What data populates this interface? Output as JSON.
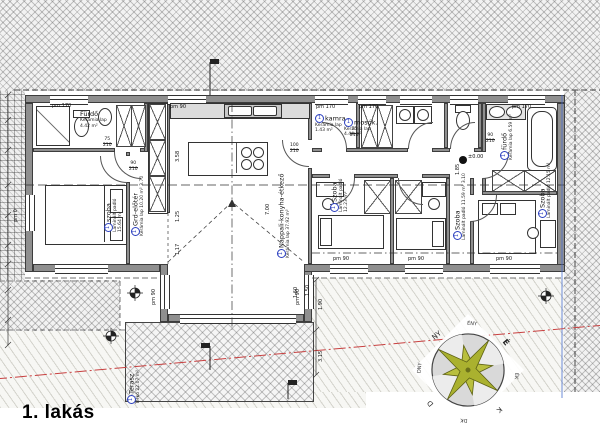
{
  "title": "1. lakás",
  "badge": "1",
  "rooms": [
    {
      "name": "Fürdő",
      "floor": "Kerámia lap",
      "area": "4.42 m²"
    },
    {
      "name": "szoba",
      "floor": "Laminált padló",
      "area": "15.64 m²"
    },
    {
      "name": "Grd-előtér",
      "floor": "Kerámia lap",
      "area": "10.20 m²",
      "dim": "3.70"
    },
    {
      "name": "Nappali-konyha-étkező",
      "floor": "Kerámia lap",
      "area": "37.92 m²"
    },
    {
      "name": "kamra",
      "floor": "Kerámia lap",
      "area": "1.43 m²"
    },
    {
      "name": "mosók.",
      "floor": "Kerámia lap",
      "area": "4.44 m²"
    },
    {
      "name": "fürdő",
      "floor": "Kerámia lap",
      "area": "6.59 m²"
    },
    {
      "name": "Szoba",
      "floor": "Laminált padló",
      "area": "12.23 m²"
    },
    {
      "name": "Szoba",
      "floor": "Laminált padló",
      "area": "11.59 m²",
      "dim": "3.10"
    },
    {
      "name": "Szoba",
      "floor": "Laminált padló",
      "area": "12.15 m²"
    },
    {
      "name": "Terasz",
      "floor": "Térkő",
      "area": "22.07 m²"
    }
  ],
  "window_labels": {
    "pm170": "pm 170",
    "pm90": "pm 90",
    "pm0": "pm 0"
  },
  "door_sizes": {
    "w75": "75",
    "w90": "90",
    "w100": "100",
    "h210": "210"
  },
  "dimensions": {
    "d358": "3.58",
    "d125": "1.25",
    "d117": "1.17",
    "d700": "7.00",
    "d185": "1.85",
    "d160": "1.60",
    "d150": "1.50",
    "d190": "1.90",
    "d315": "3.15",
    "level": "±0.00"
  },
  "compass": {
    "labels": [
      "É",
      "ÉK",
      "K",
      "DK",
      "D",
      "DNY",
      "NY",
      "ÉNY"
    ]
  },
  "colors": {
    "wall": "#8f8f8f",
    "accent_blue": "#2b3fbf",
    "boundary_red": "#c84040",
    "compass_star": "#aab12f"
  }
}
